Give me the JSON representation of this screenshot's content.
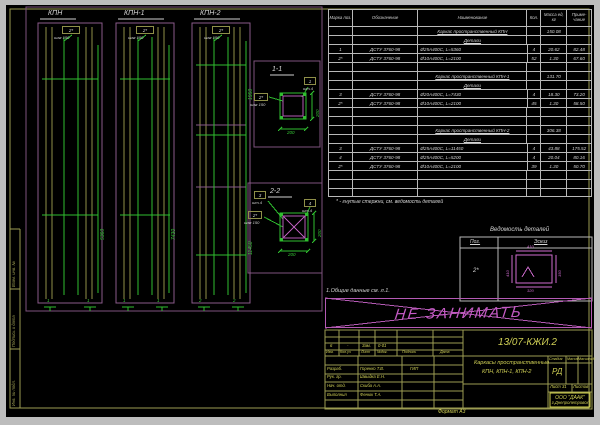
{
  "colors": {
    "frame": "#9c9c52",
    "green": "#35c435",
    "purple": "#8a5a8a",
    "pink": "#cf6ccf",
    "yellow": "#cfcf55",
    "white": "#d6d6d6",
    "background": "#000000",
    "margin": "#bdbdbd"
  },
  "columns": [
    {
      "title": "КПН",
      "pos_label": "2*",
      "step_label": "шаг 150",
      "height_dim": "5360",
      "cut_mark": "1"
    },
    {
      "title": "КПН-1",
      "pos_label": "2*",
      "step_label": "шаг 150",
      "height_dim": "7430",
      "cut_mark": "1"
    },
    {
      "title": "КПН-2",
      "pos_label": "2*",
      "step_label": "шаг 150",
      "height_dim": "11450",
      "upper_dim": "1950",
      "cut_mark": "2"
    }
  ],
  "sections": [
    {
      "title": "1-1",
      "bar_pos": "1",
      "bar_qty": "шт.4",
      "stirrup_pos": "2*",
      "stirrup_step": "шаг 150",
      "dim_w": "200",
      "dim_h": "200"
    },
    {
      "title": "2-2",
      "bar_pos": "3",
      "bar_qty": "шт.4",
      "bar2_pos": "4",
      "bar2_qty": "шт.4",
      "stirrup_pos": "2*",
      "stirrup_step": "шаг 150",
      "dim_w": "200",
      "dim_h": "200"
    }
  ],
  "spec": {
    "headers": {
      "pos": "Марка поз.",
      "oboz": "Обозначение",
      "name": "Наименование",
      "qty": "Кол.",
      "mass": "Масса ед, кг",
      "note": "Приме- чание"
    },
    "rows": [
      {
        "type": "group",
        "name": "Каркас пространственный КПН",
        "mass": "150.08"
      },
      {
        "type": "sub",
        "name": "Детали"
      },
      {
        "type": "item",
        "pos": "1",
        "oboz": "ДСТУ 3760-98",
        "name": "Ø25А400С, L=5360",
        "qty": "4",
        "mass": "20.62",
        "note": "82.48"
      },
      {
        "type": "item",
        "pos": "2*",
        "oboz": "ДСТУ 3760-98",
        "name": "Ø10А400С, L=2100",
        "qty": "52",
        "mass": "1.30",
        "note": "67.60"
      },
      {
        "type": "blank"
      },
      {
        "type": "group",
        "name": "Каркас пространственный КПН-1",
        "mass": "131.70"
      },
      {
        "type": "sub",
        "name": "Детали"
      },
      {
        "type": "item",
        "pos": "3",
        "oboz": "ДСТУ 3760-98",
        "name": "Ø20А400С, L=7430",
        "qty": "4",
        "mass": "18.30",
        "note": "73.20"
      },
      {
        "type": "item",
        "pos": "2*",
        "oboz": "ДСТУ 3760-98",
        "name": "Ø10А400С, L=2100",
        "qty": "45",
        "mass": "1.30",
        "note": "58.50"
      },
      {
        "type": "blank"
      },
      {
        "type": "blank"
      },
      {
        "type": "group",
        "name": "Каркас пространственный КПН-2",
        "mass": "306.38"
      },
      {
        "type": "sub",
        "name": "Детали"
      },
      {
        "type": "item",
        "pos": "3",
        "oboz": "ДСТУ 3760-98",
        "name": "Ø25А400С, L=11450",
        "qty": "4",
        "mass": "43.88",
        "note": "175.52"
      },
      {
        "type": "item",
        "pos": "4",
        "oboz": "ДСТУ 3760-98",
        "name": "Ø25А400С, L=5200",
        "qty": "4",
        "mass": "20.04",
        "note": "80.16"
      },
      {
        "type": "item",
        "pos": "2*",
        "oboz": "ДСТУ 3760-98",
        "name": "Ø10А400С, L=2100",
        "qty": "39",
        "mass": "1.30",
        "note": "50.70"
      },
      {
        "type": "blank"
      },
      {
        "type": "blank"
      },
      {
        "type": "blank"
      }
    ]
  },
  "notes": {
    "footnote": "* - гнутые стержни, см. ведомость деталей",
    "general": "1.Общие данные см. л.1.",
    "watermark": "НЕ ЗАНИМАТЬ"
  },
  "vedomost": {
    "title": "Ведомость деталей",
    "col1": "Поз.",
    "col2": "Эскиз",
    "pos": "2*",
    "dim_top": "410",
    "dim_left": "410",
    "dim_right": "150",
    "dim_bottom": "320"
  },
  "titleblock": {
    "doc_number": "13/07-КЖИ.2",
    "revision_values": [
      "6",
      "-",
      "Зам.",
      "0-01"
    ],
    "revision_headers": [
      "Изм.",
      "Кол.уч",
      "Лист",
      "№док.",
      "Подпись",
      "Дата"
    ],
    "staff": [
      {
        "role": "Разраб.",
        "name": "Горенко Т.В.",
        "extra": "ГИП"
      },
      {
        "role": "Рук. гр.",
        "name": "Швыдка Е.Н."
      },
      {
        "role": "Нач. отд.",
        "name": "Скиба А.А."
      },
      {
        "role": "Выполнил",
        "name": "Фенюк Т.А."
      }
    ],
    "title_line1": "Каркасы пространственные",
    "title_line2": "КПН, КПН-1, КПН-2",
    "stage_headers": [
      "Стадия",
      "Масса",
      "Масштаб"
    ],
    "stage_value": "РД",
    "sheet_label": "Лист 31",
    "sheets_label": "Листов",
    "company_line1": "ООО \"ДААК\"",
    "company_line2": "г.Днепропетровск",
    "format_label": "Формат А3"
  },
  "frame": {
    "labels": [
      "Взам. инв. №",
      "Подпись и дата",
      "Инв. № подл."
    ]
  }
}
